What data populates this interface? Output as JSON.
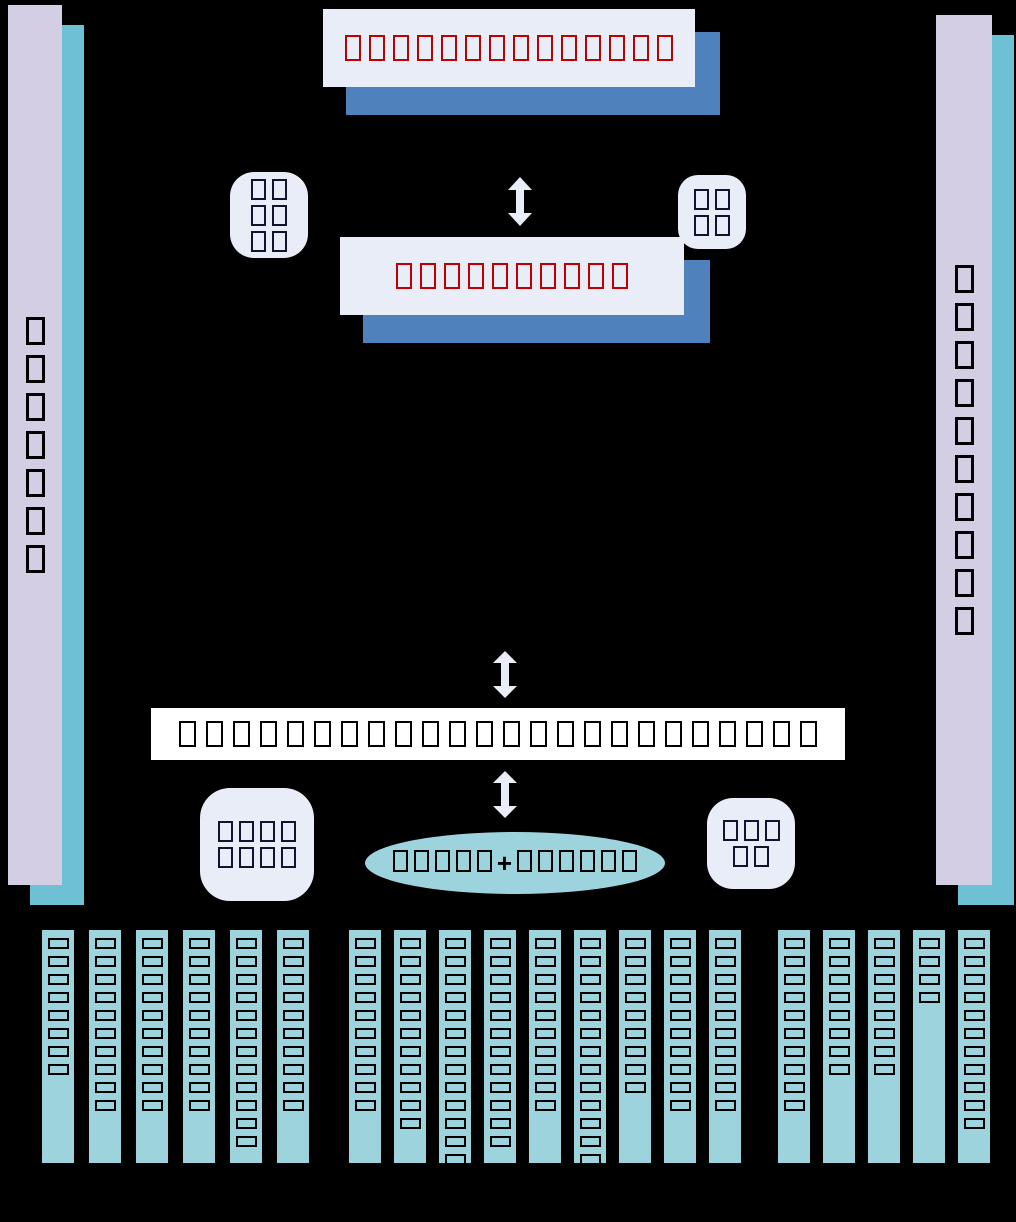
{
  "diagram": {
    "background": "#000000",
    "palette": {
      "panel_light": "#e9edf7",
      "shadow_blue": "#4f81bd",
      "bar_lavender": "#d4cee4",
      "bar_teal": "#6ec0d4",
      "column_teal": "#9cd3dd",
      "title_glyph_red": "#c00000",
      "glyph_dark": "#000000",
      "center_band_bg": "#ffffff"
    },
    "left_side_bar": {
      "glyph_count": 7
    },
    "right_side_bar": {
      "glyph_count": 10
    },
    "top_title_box": {
      "glyph_count": 14
    },
    "second_title_box": {
      "glyph_count": 10
    },
    "top_left_badge": {
      "rows": [
        2,
        2,
        2
      ]
    },
    "top_right_badge": {
      "rows": [
        2,
        2
      ]
    },
    "center_band": {
      "glyph_count": 24
    },
    "bottom_left_badge": {
      "rows": [
        4,
        4
      ]
    },
    "bottom_right_badge": {
      "rows": [
        3,
        2
      ]
    },
    "ellipse": {
      "left_glyphs": 5,
      "plus": "+",
      "right_glyphs": 6
    },
    "department_columns": {
      "groups": [
        {
          "columns": [
            8,
            10,
            10,
            10,
            12,
            10
          ]
        },
        {
          "columns": [
            10,
            11,
            13,
            12,
            10,
            13,
            9,
            10,
            10
          ]
        },
        {
          "columns": [
            10,
            8,
            8,
            4,
            11
          ]
        }
      ]
    }
  }
}
